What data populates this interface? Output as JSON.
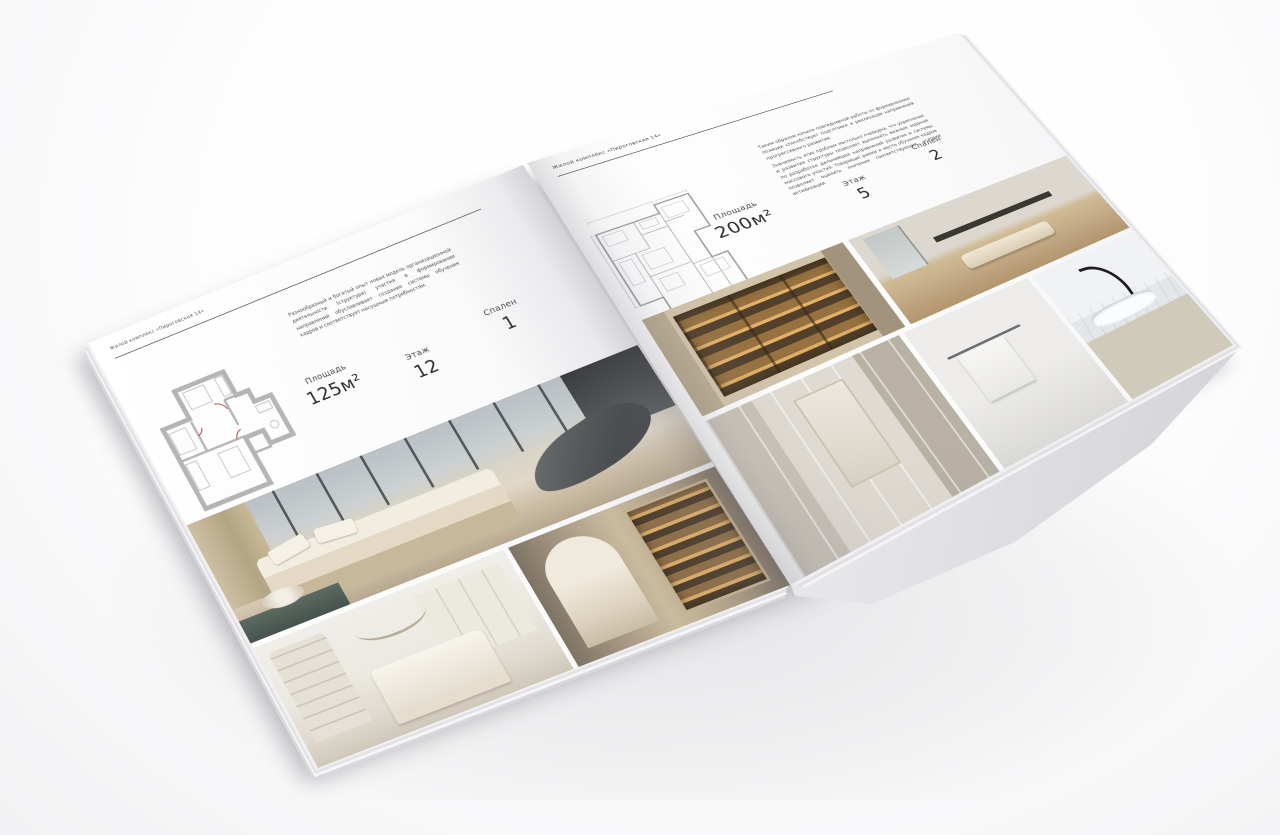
{
  "brochure": {
    "left_page": {
      "header": "Жилой комплекс «Пироговская 14»",
      "intro": "Разнообразный и богатый опыт новая модель организационной деятельности (структура) участия в формировании направлений обуславливает создание системы обучения кадров и соответствует насущным потребностям.",
      "specs": [
        {
          "label": "Площадь",
          "value": "125м²"
        },
        {
          "label": "Этаж",
          "value": "12"
        },
        {
          "label": "Спален",
          "value": "1"
        }
      ]
    },
    "right_page": {
      "header": "Жилой комплекс «Пироговская 14»",
      "intro_1": "Таким образом начало повседневной работы по формированию позиции способствует подготовке и реализации направлений прогрессивного развития.",
      "intro_2": "Значимость этих проблем настолько очевидна, что укрепление и развитие структуры позволяет выполнять важные задания по разработке дальнейших направлений развития и системы массового участия. Товарищи! рамки и место обучения кадров позволяет оценить значение соответствующих условий активизации.",
      "specs": [
        {
          "label": "Площадь",
          "value": "200м²"
        },
        {
          "label": "Этаж",
          "value": "5"
        },
        {
          "label": "Спален",
          "value": "2"
        }
      ]
    },
    "palette": {
      "paper": "#fbfbfc",
      "ink": "#3e3e40",
      "rule": "#56565a",
      "plan_wall": "#b5b5b8",
      "plan_line": "#98989b",
      "door_accent": "#c0564f",
      "photo_warm": "#d2c4aa",
      "photo_dark": "#44474a",
      "shelf_glow": "#e2b169"
    }
  }
}
